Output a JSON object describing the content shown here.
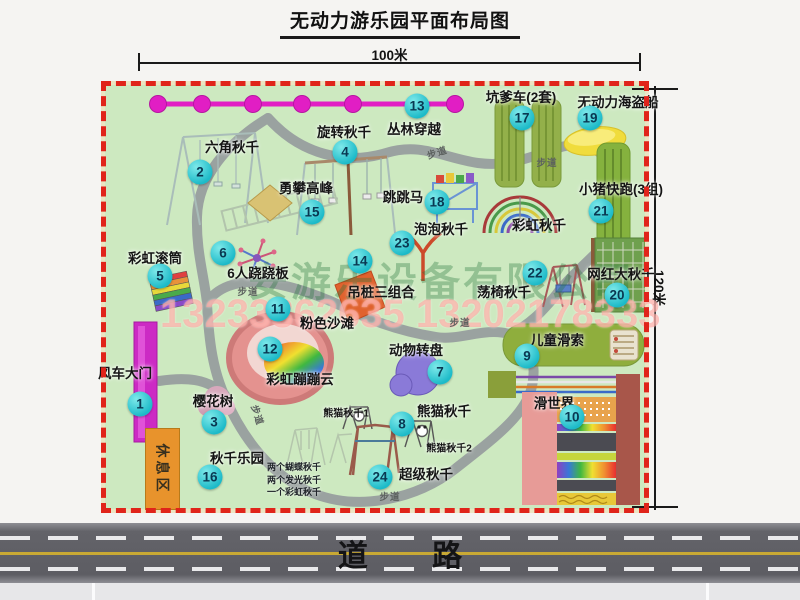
{
  "title": "无动力游乐园平面布局图",
  "dimensions": {
    "width_label": "100米",
    "height_label": "120米"
  },
  "road": {
    "label": "道 路"
  },
  "watermarks": {
    "company": "安游乐设备有限公司",
    "phone": "13233862635 13202178333"
  },
  "labels": {
    "path": "步道",
    "rest_area": "休息区",
    "rainbow_swing": "彩虹秋千",
    "panda_swing_1": "熊猫秋千1",
    "panda_swing_2": "熊猫秋千2"
  },
  "notes": {
    "swing_park": [
      "两个蝴蝶秋千",
      "两个发光秋千",
      "一个彩虹秋千"
    ]
  },
  "attractions": [
    {
      "num": 1,
      "label": "风车大门"
    },
    {
      "num": 2,
      "label": "六角秋千"
    },
    {
      "num": 3,
      "label": "樱花树"
    },
    {
      "num": 4,
      "label": "旋转秋千"
    },
    {
      "num": 5,
      "label": "彩虹滚筒"
    },
    {
      "num": 6,
      "label": "6人跷跷板"
    },
    {
      "num": 7,
      "label": "动物转盘"
    },
    {
      "num": 8,
      "label": "熊猫秋千"
    },
    {
      "num": 9,
      "label": "儿童滑索"
    },
    {
      "num": 10,
      "label": "滑世界"
    },
    {
      "num": 11,
      "label": "粉色沙滩"
    },
    {
      "num": 12,
      "label": "彩虹蹦蹦云"
    },
    {
      "num": 13,
      "label": "丛林穿越"
    },
    {
      "num": 14,
      "label": "吊桩三组合"
    },
    {
      "num": 15,
      "label": "勇攀高峰"
    },
    {
      "num": 16,
      "label": "秋千乐园"
    },
    {
      "num": 17,
      "label": "坑爹车(2套)"
    },
    {
      "num": 18,
      "label": "跳跳马"
    },
    {
      "num": 19,
      "label": "无动力海盗船"
    },
    {
      "num": 20,
      "label": "网红大秋千"
    },
    {
      "num": 21,
      "label": "小猪快跑(3组)"
    },
    {
      "num": 22,
      "label": "荡椅秋千"
    },
    {
      "num": 23,
      "label": "泡泡秋千"
    },
    {
      "num": 24,
      "label": "超级秋千"
    }
  ],
  "colors": {
    "map_green": "#cde9c0",
    "path_gray": "#9aa2a0",
    "border_red": "#e0241a",
    "badge_teal": "#1cbac8",
    "chain_magenta": "#e11ec4",
    "gate_magenta": "#cc2ac4",
    "rest_orange": "#e8932c",
    "road_gray": "#5d5d63",
    "center_line_yellow": "#c9a934"
  }
}
